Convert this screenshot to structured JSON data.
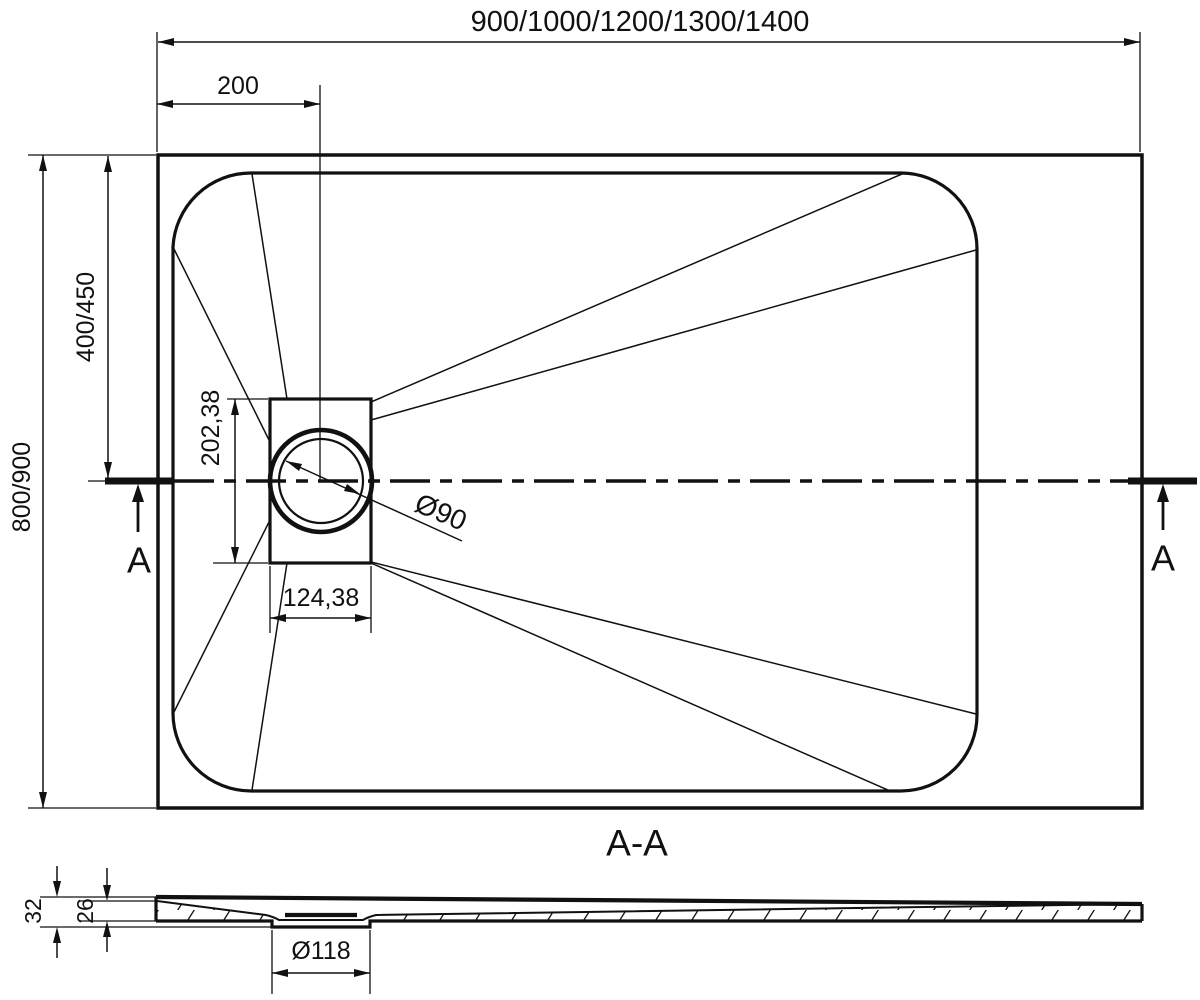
{
  "top_view": {
    "width_series_label": "900/1000/1200/1300/1400",
    "drain_offset_label": "200",
    "depth_series_label": "800/900",
    "half_depth_label": "400/450",
    "drain_box_height_label": "202,38",
    "drain_box_width_label": "124,38",
    "drain_diameter_label": "Ø90",
    "section_marker_left": "A",
    "section_marker_right": "A"
  },
  "section_view": {
    "title": "A-A",
    "total_height_label": "32",
    "inner_height_label": "26",
    "flange_diameter_label": "Ø118"
  },
  "colors": {
    "line": "#111111",
    "background": "#ffffff"
  }
}
